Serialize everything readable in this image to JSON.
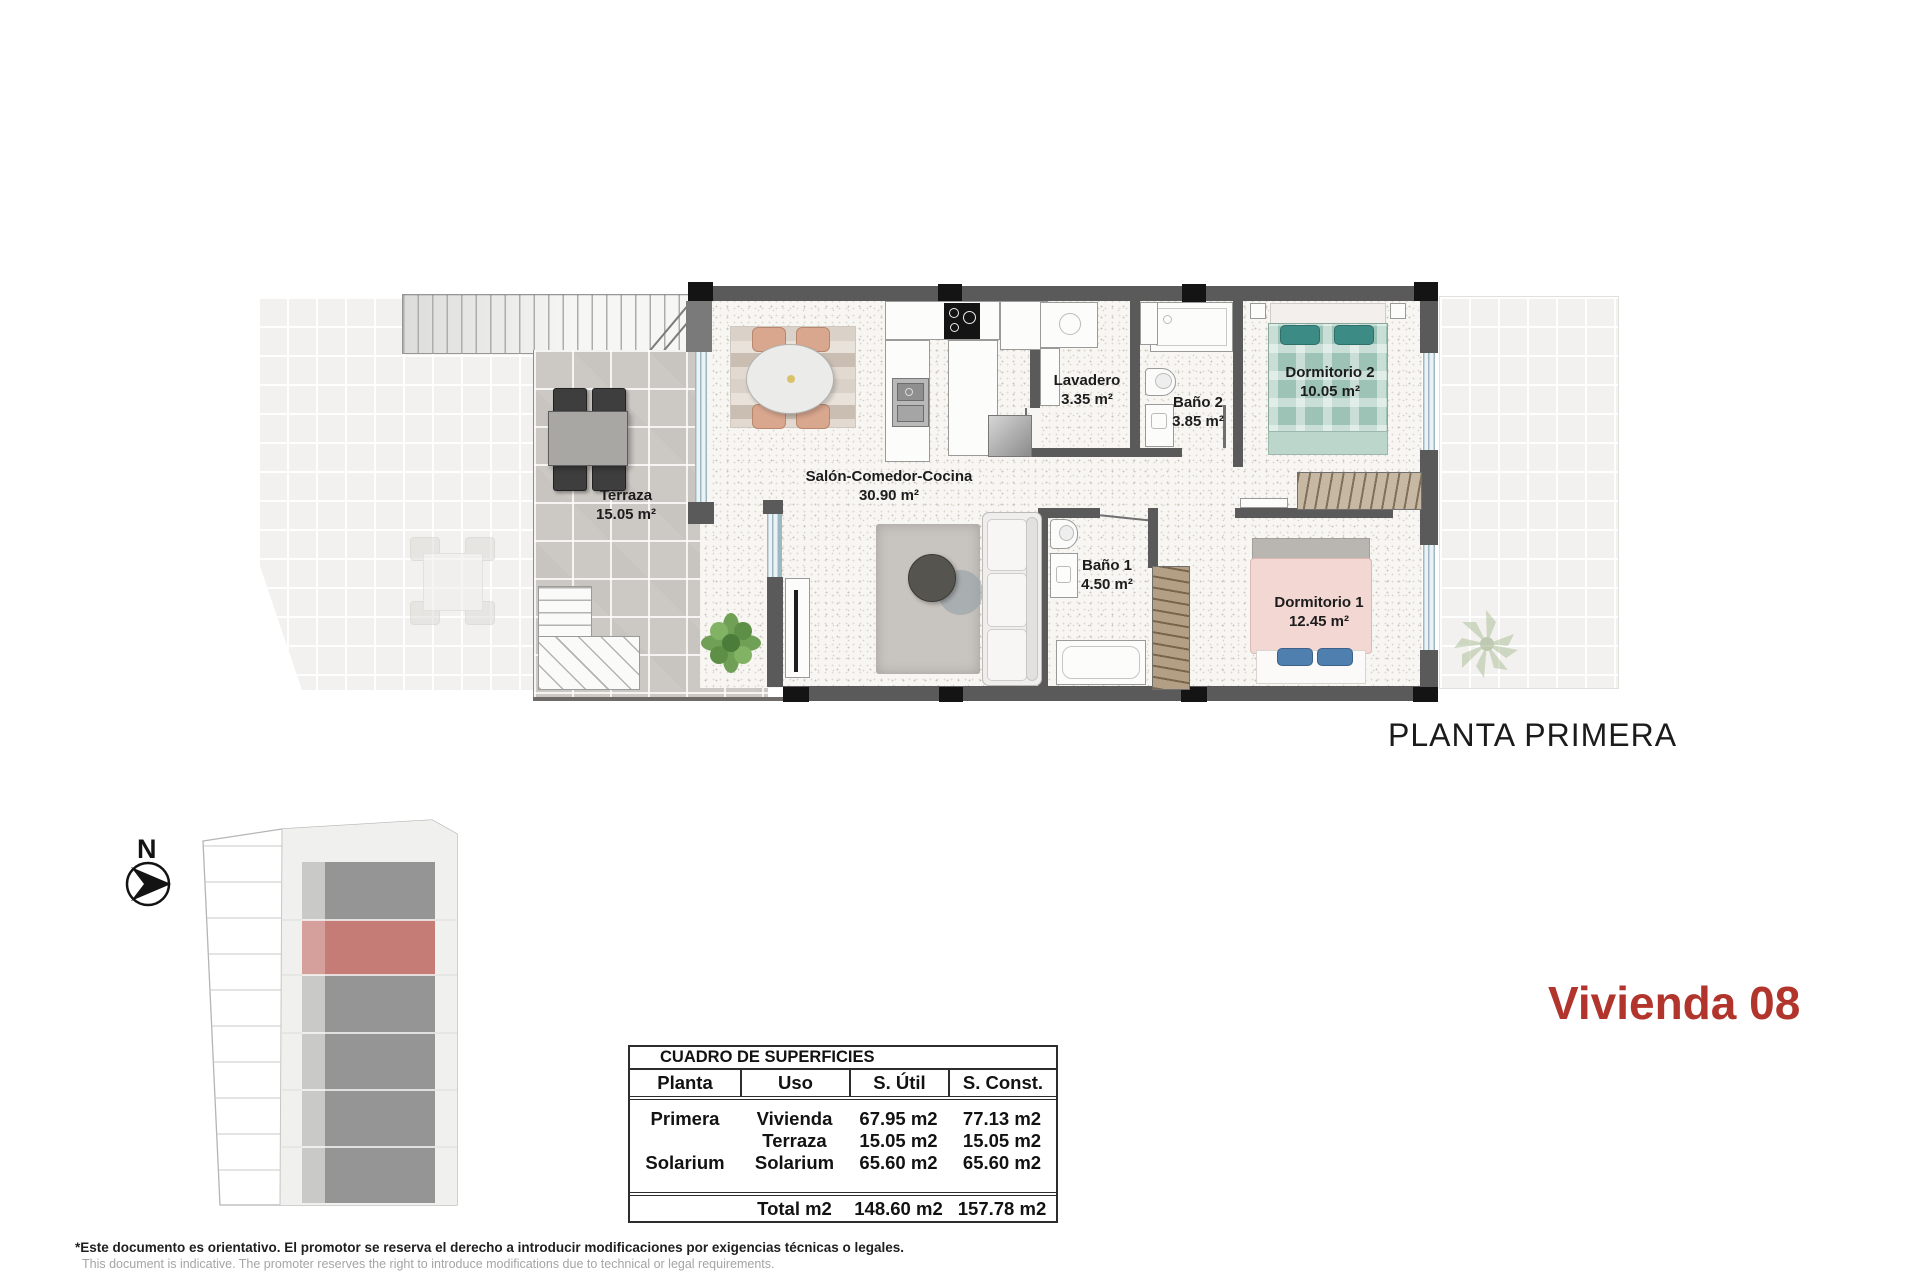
{
  "floor_plan": {
    "title": "PLANTA PRIMERA",
    "rooms": [
      {
        "name": "Terraza",
        "area": "15.05 m²"
      },
      {
        "name": "Salón-Comedor-Cocina",
        "area": "30.90 m²"
      },
      {
        "name": "Lavadero",
        "area": "3.35 m²"
      },
      {
        "name": "Baño 2",
        "area": "3.85 m²"
      },
      {
        "name": "Dormitorio 2",
        "area": "10.05 m²"
      },
      {
        "name": "Baño 1",
        "area": "4.50 m²"
      },
      {
        "name": "Dormitorio 1",
        "area": "12.45 m²"
      }
    ]
  },
  "unit_title": "Vivienda 08",
  "site_plan": {
    "north_label": "N",
    "highlight_color": "#c57b76"
  },
  "surface_table": {
    "title": "CUADRO DE SUPERFICIES",
    "columns": [
      "Planta",
      "Uso",
      "S. Útil",
      "S. Const."
    ],
    "rows": [
      {
        "planta": "Primera",
        "uso": "Vivienda",
        "util": "67.95 m2",
        "sconst": "77.13 m2"
      },
      {
        "planta": "",
        "uso": "Terraza",
        "util": "15.05 m2",
        "sconst": "15.05 m2"
      },
      {
        "planta": "Solarium",
        "uso": "Solarium",
        "util": "65.60 m2",
        "sconst": "65.60 m2"
      }
    ],
    "total": {
      "label": "Total m2",
      "util": "148.60 m2",
      "sconst": "157.78 m2"
    }
  },
  "colors": {
    "title_red": "#b2352d",
    "highlight_red": "#c57b76"
  },
  "footer": {
    "line_es": "*Este documento es orientativo. El promotor se reserva el derecho a introducir modificaciones por exigencias técnicas o legales.",
    "line_en": "This document is indicative. The promoter reserves the right to introduce modifications due to technical or legal requirements."
  }
}
